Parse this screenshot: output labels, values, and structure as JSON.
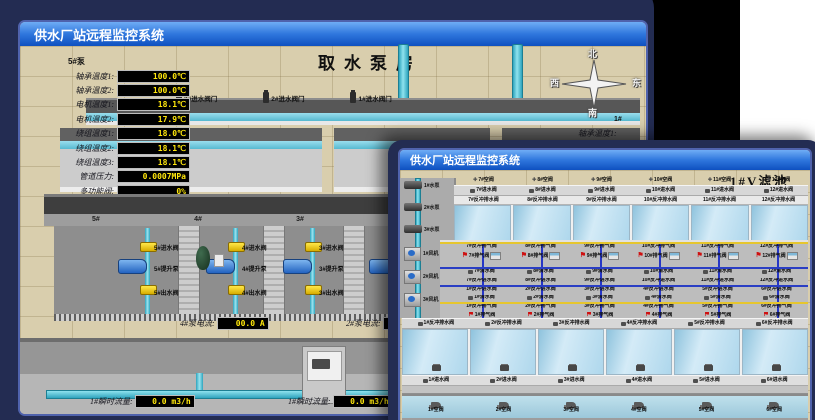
{
  "back_window": {
    "titlebar": "供水厂站远程监控系统",
    "scene_title": "取水泵房",
    "pump_panel": {
      "header": "5#泵",
      "rows": [
        {
          "label": "轴承温度1:",
          "value": "100.0℃"
        },
        {
          "label": "轴承温度2:",
          "value": "100.0℃"
        },
        {
          "label": "电机温度1:",
          "value": "18.1℃"
        },
        {
          "label": "电机温度2:",
          "value": "17.9℃"
        },
        {
          "label": "绕组温度1:",
          "value": "18.0℃"
        },
        {
          "label": "绕组温度2:",
          "value": "18.1℃"
        },
        {
          "label": "绕组温度3:",
          "value": "18.1℃"
        },
        {
          "label": "管道压力:",
          "value": "0.0007MPa"
        },
        {
          "label": "多功能阀:",
          "value": "0%"
        }
      ]
    },
    "compass": {
      "north": "北",
      "west": "西",
      "south": "南",
      "east": "东"
    },
    "right_panel": {
      "header": "1#",
      "rows": [
        "轴承温度1:",
        "轴承温度2:"
      ]
    },
    "inlet_gate_valves": [
      "3#进水阀门",
      "2#进水阀门",
      "1#进水阀门"
    ],
    "pump_room": {
      "bay_headers": [
        "5#",
        "4#",
        "3#",
        "2#"
      ],
      "bays": [
        {
          "inlet": "5#进水阀",
          "pump": "5#提升泵",
          "outlet": "5#出水阀"
        },
        {
          "inlet": "4#进水阀",
          "pump": "4#提升泵",
          "outlet": "4#出水阀"
        },
        {
          "inlet": "3#进水阀",
          "pump": "3#提升泵",
          "outlet": "3#出水阀"
        }
      ]
    },
    "current_displays": [
      {
        "label": "4#泵电流:",
        "value": "00.0 A"
      },
      {
        "label": "2#泵电流:",
        "value": ""
      }
    ],
    "flow_displays": [
      {
        "label": "1#瞬时流量:",
        "value": "0.0 m3/h"
      },
      {
        "label": "1#瞬时流量:",
        "value": "0.0 m3/h"
      }
    ]
  },
  "front_window": {
    "titlebar": "供水厂站远程监控系统",
    "scene_title": "1#V滤池",
    "pumps": [
      "1#水泵",
      "2#水泵",
      "3#水泵"
    ],
    "blowers": [
      "1#风机",
      "2#风机",
      "3#风机"
    ],
    "rows": {
      "air_top": [
        "7#空阀",
        "8#空阀",
        "9#空阀",
        "10#空阀",
        "11#空阀",
        "12#空阀"
      ],
      "inlet_top": [
        "7#进水阀",
        "8#进水阀",
        "9#进水阀",
        "10#进水阀",
        "11#进水阀",
        "12#进水阀"
      ],
      "drain_top": [
        "7#反冲排水阀",
        "8#反冲排水阀",
        "9#反冲排水阀",
        "10#反冲排水阀",
        "11#反冲排水阀",
        "12#反冲排水阀"
      ],
      "bf_exhaust_top": [
        "7#反冲排气阀",
        "8#反冲排气阀",
        "9#反冲排气阀",
        "10#反冲排气阀",
        "11#反冲排气阀",
        "12#反冲排气阀"
      ],
      "exhaust_top": [
        "7#排气阀",
        "8#排气阀",
        "9#排气阀",
        "10#排气阀",
        "11#排气阀",
        "12#排气阀"
      ],
      "clean_top": [
        "7#清水阀",
        "8#清水阀",
        "9#清水阀",
        "10#清水阀",
        "11#清水阀",
        "12#清水阀"
      ],
      "bf_inlet_top": [
        "7#反冲进水阀",
        "8#反冲进水阀",
        "9#反冲进水阀",
        "10#反冲进水阀",
        "11#反冲进水阀",
        "12#反冲进水阀"
      ],
      "bf_inlet_bottom": [
        "1#反冲进水阀",
        "2#反冲进水阀",
        "3#反冲进水阀",
        "4#反冲进水阀",
        "5#反冲进水阀",
        "6#反冲进水阀"
      ],
      "clean_bottom": [
        "1#清水阀",
        "2#清水阀",
        "3#清水阀",
        "4#清水阀",
        "5#清水阀",
        "6#清水阀"
      ],
      "bf_exhaust_bottom": [
        "1#反冲排气阀",
        "2#反冲排气阀",
        "3#反冲排气阀",
        "4#反冲排气阀",
        "5#反冲排气阀",
        "6#反冲排气阀"
      ],
      "exhaust_bottom": [
        "1#排气阀",
        "2#排气阀",
        "3#排气阀",
        "4#排气阀",
        "5#排气阀",
        "6#排气阀"
      ],
      "drain_bottom": [
        "1#反冲排水阀",
        "2#反冲排水阀",
        "3#反冲排水阀",
        "4#反冲排水阀",
        "5#反冲排水阀",
        "6#反冲排水阀"
      ],
      "inlet_bottom": [
        "1#进水阀",
        "2#进水阀",
        "3#进水阀",
        "4#进水阀",
        "5#进水阀",
        "6#进水阀"
      ],
      "air_bottom": [
        "1#空阀",
        "2#空阀",
        "3#空阀",
        "4#空阀",
        "5#空阀",
        "6#空阀"
      ]
    },
    "colors": {
      "chrome_navy": "#232c52",
      "titlebar_blue": "#2f77dd",
      "floor_beige": "#d9cead",
      "pipe_cyan": "#5fc9dd",
      "value_yellow": "#ffe70c",
      "water_blue": "#aed7ec"
    }
  }
}
